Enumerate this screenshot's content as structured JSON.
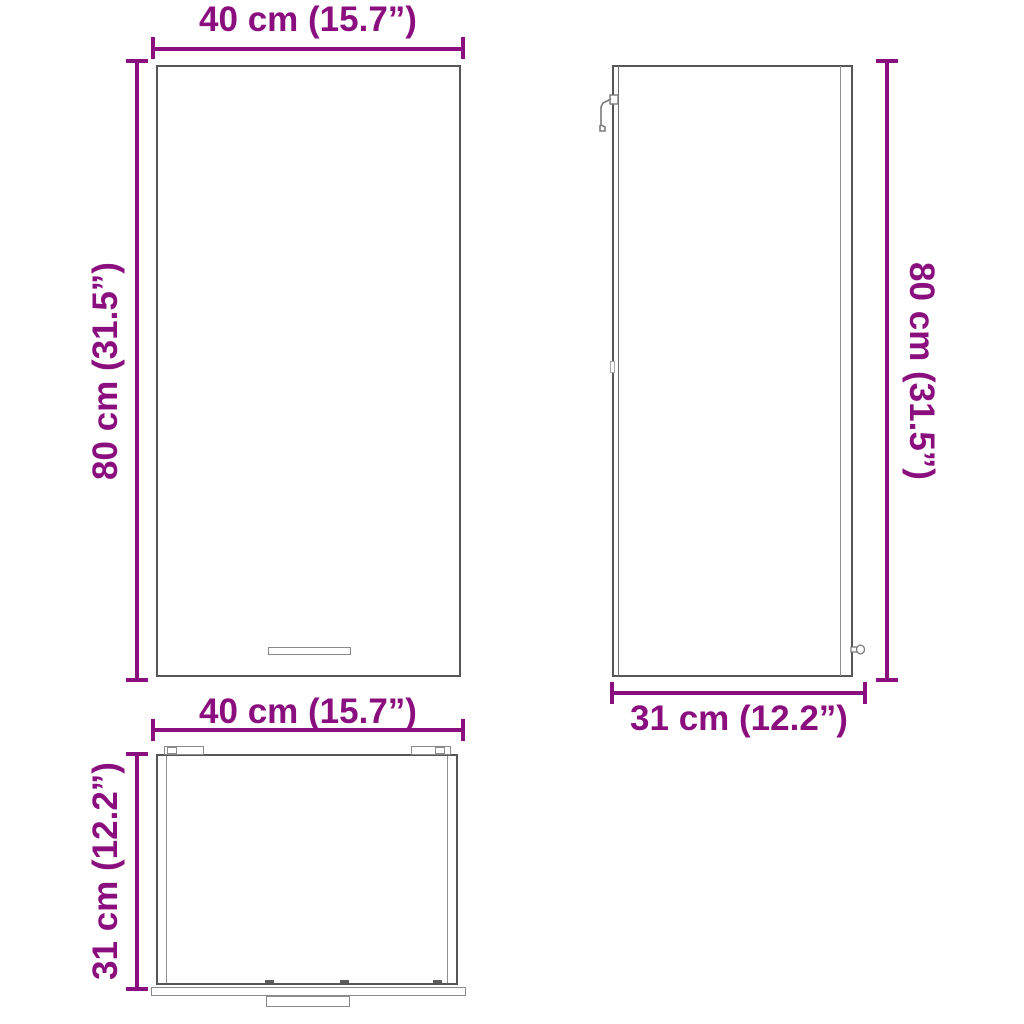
{
  "diagram": {
    "type": "product-dimension-drawing",
    "subject": "wall-cabinet",
    "accent_color": "#8A0E7E",
    "outline_color": "#565656"
  },
  "views": {
    "front": {
      "width_label": "40 cm (15.7”)",
      "height_label": "80 cm (31.5”)"
    },
    "side": {
      "height_label": "80 cm (31.5”)",
      "depth_label": "31 cm (12.2”)"
    },
    "top": {
      "width_label": "40 cm (15.7”)",
      "depth_label": "31 cm (12.2”)"
    }
  }
}
